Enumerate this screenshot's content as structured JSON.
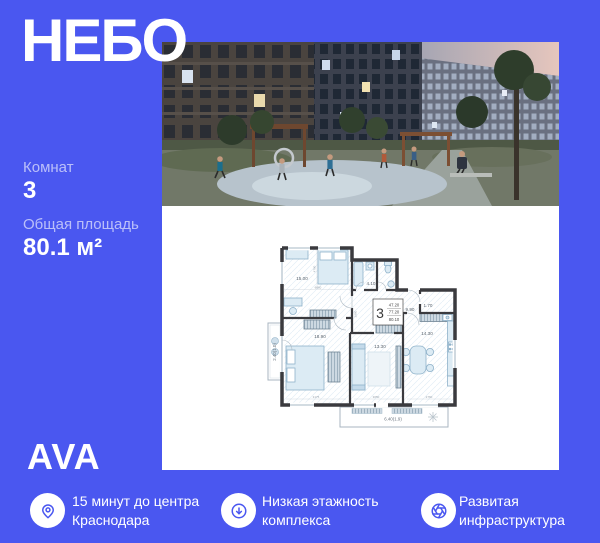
{
  "colors": {
    "background": "#4A57F0",
    "panel": "#FFFFFF",
    "wall": "#3A3A3E",
    "furniture": "#DCEBF4",
    "accent": "#4A57F0"
  },
  "title": "НЕБО",
  "specs": {
    "rooms_label": "Комнат",
    "rooms_value": "3",
    "area_label": "Общая площадь",
    "area_value": "80.1 м²"
  },
  "logo": "AVA",
  "features": [
    {
      "icon": "location-pin-icon",
      "line1": "15 минут до центра",
      "line2": "Краснодара"
    },
    {
      "icon": "arrow-down-circle-icon",
      "line1": "Низкая этажность",
      "line2": "комплекса"
    },
    {
      "icon": "aperture-icon",
      "line1": "Развитая",
      "line2": "инфраструктура"
    }
  ],
  "floorplan": {
    "stamp": {
      "rooms": "3",
      "living": "47.20",
      "apartment": "77.20",
      "total": "80.10"
    },
    "rooms": {
      "bedroom_top": "15.00",
      "bathroom": "4.10",
      "hall": "9.90",
      "closet": "1.70",
      "kitchen": "14.30",
      "bedroom_left": "18.90",
      "living": "13.30",
      "balcony_left": "2.40(1.0)",
      "balcony_bottom": "6.40(1.9)"
    },
    "dims": {
      "d1": "6060",
      "d2": "4790",
      "d3": "2980",
      "d4": "3175",
      "d5": "3050",
      "d6": "2760"
    }
  }
}
